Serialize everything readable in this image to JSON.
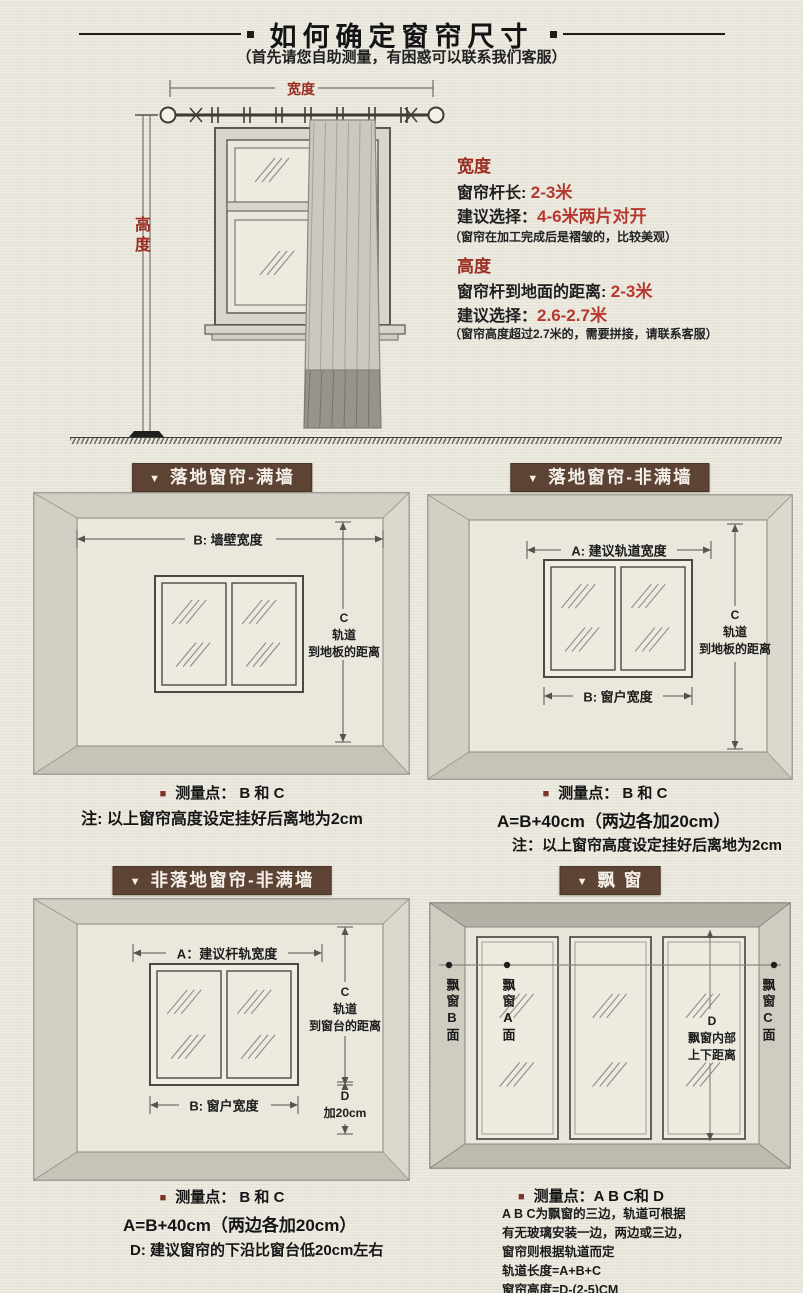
{
  "shared": {
    "triangle": "▼",
    "bullet": "■"
  },
  "header": {
    "title": "如何确定窗帘尺寸",
    "subtitle": "（首先请您自助测量，有困惑可以联系我们客服）"
  },
  "top_diagram": {
    "width_label": "宽度",
    "height_label": "高度"
  },
  "width_info": {
    "heading": "宽度",
    "l1": "窗帘杆长: ",
    "v1": "2-3米",
    "l2": "建议选择：",
    "v2": "4-6米两片对开",
    "note": "（窗帘在加工完成后是褶皱的，比较美观）"
  },
  "height_info": {
    "heading": "高度",
    "l1": "窗帘杆到地面的距离: ",
    "v1": "2-3米",
    "l2": "建议选择：",
    "v2": "2.6-2.7米",
    "note": "（窗帘高度超过2.7米的，需要拼接，请联系客服）"
  },
  "panels": {
    "p1": {
      "title": "落地窗帘-满墙",
      "b": "B: 墙壁宽度",
      "c1": "C",
      "c2": "轨道",
      "c3": "到地板的距离",
      "note1": "测量点： B 和 C",
      "note2": "注: 以上窗帘高度设定挂好后离地为2cm"
    },
    "p2": {
      "title": "落地窗帘-非满墙",
      "a": "A: 建议轨道宽度",
      "b": "B: 窗户宽度",
      "c1": "C",
      "c2": "轨道",
      "c3": "到地板的距离",
      "note1": "测量点： B 和 C",
      "note2": "A=B+40cm（两边各加20cm）",
      "note3": "注：以上窗帘高度设定挂好后离地为2cm"
    },
    "p3": {
      "title": "非落地窗帘-非满墙",
      "a": "A：建议杆轨宽度",
      "b": "B: 窗户宽度",
      "c1": "C",
      "c2": "轨道",
      "c3": "到窗台的距离",
      "d1": "D",
      "d2": "加20cm",
      "note1": "测量点： B 和 C",
      "note2": "A=B+40cm（两边各加20cm）",
      "note3": "D: 建议窗帘的下沿比窗台低20cm左右"
    },
    "p4": {
      "title": "飘 窗",
      "left_face": "飘窗B面",
      "pane1_face": "飘窗A面",
      "d1": "D",
      "d2": "飘窗内部",
      "d3": "上下距离",
      "right_face": "飘窗C面",
      "note1": "测量点：A B C和 D",
      "lines": [
        "A B C为飘窗的三边，轨道可根据",
        "有无玻璃安装一边，两边或三边，",
        "窗帘则根据轨道而定",
        "轨道长度=A+B+C",
        "窗帘高度=D-(2-5)CM"
      ]
    }
  },
  "colors": {
    "accent_red": "#9b2d22",
    "value_red": "#b5382f",
    "bar_brown": "#5d4334",
    "bullet_brown": "#7a3327"
  }
}
